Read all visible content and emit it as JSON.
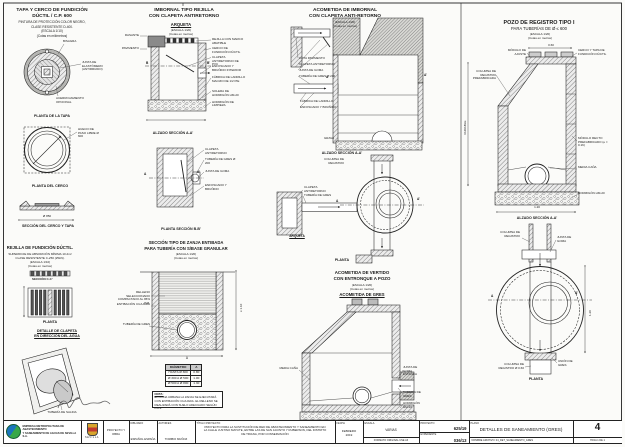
{
  "p1": {
    "title1": "TAPA Y CERCO DE FUNDICIÓN",
    "title2": "DÚCTIL / C.P. 600",
    "sub1": "PINTURA DE PROTECCIÓN COLOR NEGRO,",
    "sub2": "CLASE RESISTENTE D-400.",
    "sub3": "(ESCALA 1/10)",
    "sub4": "(Cotas en milímetros)",
    "lbl_bisagra": "BISAGRA",
    "lbl_junta": "JUNTA DE ELASTÓMERO (ANTIRRUIDO)",
    "lbl_acerrojamiento": "ACERROJAMIENTO OPCIONAL",
    "cap_tapa": "PLANTA DE LA TAPA",
    "lbl_hueco": "HUECO DE PASO LIBRE Ø 600",
    "cap_cerco": "PLANTA DEL CERCO",
    "dim_seccion": "Ø 850",
    "cap_seccion": "SECCIÓN DEL CERCO Y TAPA"
  },
  "p1b": {
    "title": "REJILLA DE FUNDICIÓN DÚCTIL.",
    "sub1": "SUPERFICIE DE ABSORCIÓN MÍNIMA 10 dm²",
    "sub2": "CLASE RESISTENTE C-250 (25kN).",
    "sub3": "(ESCALA 1/10)",
    "sub4": "(Cotas en metros)",
    "cap_cc": "SECCIÓN C-C'",
    "cap_planta": "PLANTA",
    "det1": "DETALLE DE CLAPETA",
    "det2": "EN DIRECCIÓN DEL AGUA",
    "lbl_salida": "TUBERÍA DE SALIDA"
  },
  "p2": {
    "title1": "IMBORNAL TIPO REJILLA",
    "title2": "CON CLAPETA ANTIRETORNO",
    "arqueta": "ARQUETA",
    "sub1": "(ESCALA 1/20)",
    "sub2": "(Cotas en metros)",
    "left1": "RASANTE",
    "left2": "PAVIMENTO",
    "labels": [
      "REJILLA CON MARCO ABATIBLE",
      "CERCO DE FUNDICIÓN DÚCTIL",
      "CLAPETA ANTIRETORNO DE PVC",
      "ENFOSCADO Y BRUÑIDO INTERIOR",
      "FÁBRICA DE LADRILLO MACIZO DE 1/2 PIE",
      "SOLERA DE HORMIGÓN HM-20"
    ],
    "lbl_limpieza": "HORMIGÓN DE LIMPIEZA",
    "mark_b": "B",
    "mark_b2": "B'",
    "cap_alzado": "ALZADO SECCIÓN A-A'",
    "mark_a": "A",
    "mark_a2": "A'",
    "plan_labels": [
      "CLAPETA ANTIRETORNO",
      "TUBERÍA DE GRES Ø 200",
      "JUNTA DE GOMA",
      "ENFOSCADO Y BRUÑIDO"
    ],
    "cap_planta": "PLANTA SECCIÓN B-B'"
  },
  "p2b": {
    "title1": "SECCIÓN TIPO DE ZANJA ENTIBADA",
    "title2": "PARA TUBERÍA CON S/BASE GRANULAR",
    "sub1": "(ESCALA 1/20)",
    "sub2": "(Cotas en metros)",
    "lbl1": "RELLENO SELECCIONADO COMPACTADO AL 95% P.M.",
    "lbl2": "ENTIBACIÓN CUAJADA",
    "lbl3": "TUBERÍA DE GRES",
    "dim_h": "≥ 1.10",
    "dim_a": "A",
    "table": {
      "headers": [
        "DIÁMETRO",
        "A"
      ],
      "rows": [
        [
          "HASTA Ø 300",
          "0.80"
        ],
        [
          "Ø 300 A Ø 500",
          "1.00"
        ],
        [
          "Ø 500 A Ø 800",
          "1.30"
        ]
      ]
    },
    "nota_title": "NOTA:",
    "nota1": "EN ZONA URBANA LA ZANJA SE EJECUTARÁ CON ENTIBACIÓN CUAJADA.",
    "nota2": "EL RELLENO SE REALIZARÁ CON SUELO ADECUADO SEGÚN PG-3."
  },
  "p3": {
    "title1": "ACOMETIDA DE IMBORNAL",
    "title2": "CON CLAPETA ANTI-RETORNO",
    "sub1": "(ESCALA 1/20)",
    "sub2": "(Cotas en metros)",
    "det_labels": [
      "COTA PAVIMENTO",
      "CLAPETA ANTIRETORNO",
      "JUNTA DE GOMA",
      "TUBERÍA DE GRES Ø 200",
      "FÁBRICA DE LADRILLO",
      "ENFOSCADO Y BRUÑIDO"
    ],
    "lbl_columna": "COLUMNA DE REGISTRO",
    "lbl_grava": "GRAVA",
    "cap_alzado": "ALZADO SECCIÓN A-A'",
    "mark_a": "A",
    "mark_a2": "A'",
    "lbl_arq1": "CLAPETA ANTIRETORNO",
    "lbl_arq2": "TUBERÍA DE GRES",
    "cap_arqueta": "ARQUETA",
    "cap_planta": "PLANTA"
  },
  "p3b": {
    "title1": "ACOMETIDA DE VERTIDO",
    "title2": "CON ENTRONQUE A POZO",
    "sub1": "(ESCALA 1/20)",
    "sub2": "(Cotas en metros)",
    "heading": "ACOMETIDA DE GRES",
    "lbl_media": "MEDIA CAÑA",
    "lbl_junta": "JUNTA DE GOMA ESTANCA",
    "lbl_tuberia": "TUBERÍA DE GRES",
    "lbl_horm": "HORMIGÓN HM-20"
  },
  "p4": {
    "title1": "POZO DE REGISTRO TIPO I",
    "title2": "PARA TUBERÍAS DE Ø ≤ 600",
    "sub1": "(ESCALA 1/20)",
    "sub2": "(Cotas en metros)",
    "dim_060": "0.60",
    "lbl_modulo": "MÓDULO DE AJUSTE",
    "lbl_tapa": "CERCO Y TAPA DE FUNDICIÓN DÚCTIL",
    "lbl_columna": "COLUMNA DE REGISTRO PREFABRICADA",
    "lbl_modrecto": "MÓDULO RECTO PREFABRICADO (e = 0.16)",
    "lbl_mcana": "MEDIA CAÑA",
    "lbl_horm": "HORMIGÓN HM-20",
    "dim_var": "VARIABLE",
    "dim_120": "1.20",
    "cap_alzado": "ALZADO SECCIÓN A-A'",
    "lbl_col2": "COLUMNA DE REGISTRO",
    "lbl_junta2": "JUNTA DE GOMA",
    "mark_a": "A",
    "mark_a2": "A'",
    "dim_phi": "1.20",
    "lbl_col3": "COLUMNA DE REGISTRO Ø 0.60",
    "lbl_union": "UNIÓN DE GRES",
    "cap_planta": "PLANTA"
  },
  "tb": {
    "company1": "EMPRESA METROPOLITANA DE ABASTECIMIENTO",
    "company2": "Y SANEAMIENTO DE AGUAS DE SEVILLA S.A.",
    "city": "SEVILLA",
    "proyecto_obra": "PROYECTO Y OBRA",
    "dib_label": "DIBUJADO",
    "dib_value": "ESPAÑOL ESPAÑA",
    "aut_label": "AUTOR/ES",
    "aut_value": "TORIBIO MUÑOZ",
    "titulo_label": "TÍTULO PROYECTO:",
    "titulo1": "PROYECTO PARA LA SUSTITUCIÓN DE RED DE ABASTECIMIENTO Y SANEAMIENTO EN",
    "titulo2": "LA CALLE JUSTINO MATUTE, ENTRE LAS DE SAN JACINTO Y RUBERSON, DEL DISTRITO",
    "titulo3": "DE TRIANA, POR CONSERVACIÓN",
    "fecha_label": "FECHA",
    "fecha1": "FEBRERO",
    "fecha2": "2019",
    "escala_label": "ESCALA",
    "escala_value": "VARIAS",
    "formato": "FORMATO ORIGINAL UNE A3",
    "num1_label": "PROYECTO",
    "num1": "625/19",
    "num2_label": "EXPEDIENTE",
    "num2": "036/13",
    "plano_label": "PLANO",
    "plano_title": "DETALLES DE SANEAMIENTO (GRES)",
    "archivo": "NOMBRE ARCHIVO: 04_DET_SANEAMIENTO_GRES",
    "sheet_num": "4",
    "hoja": "HOJA 1 DE 1"
  }
}
